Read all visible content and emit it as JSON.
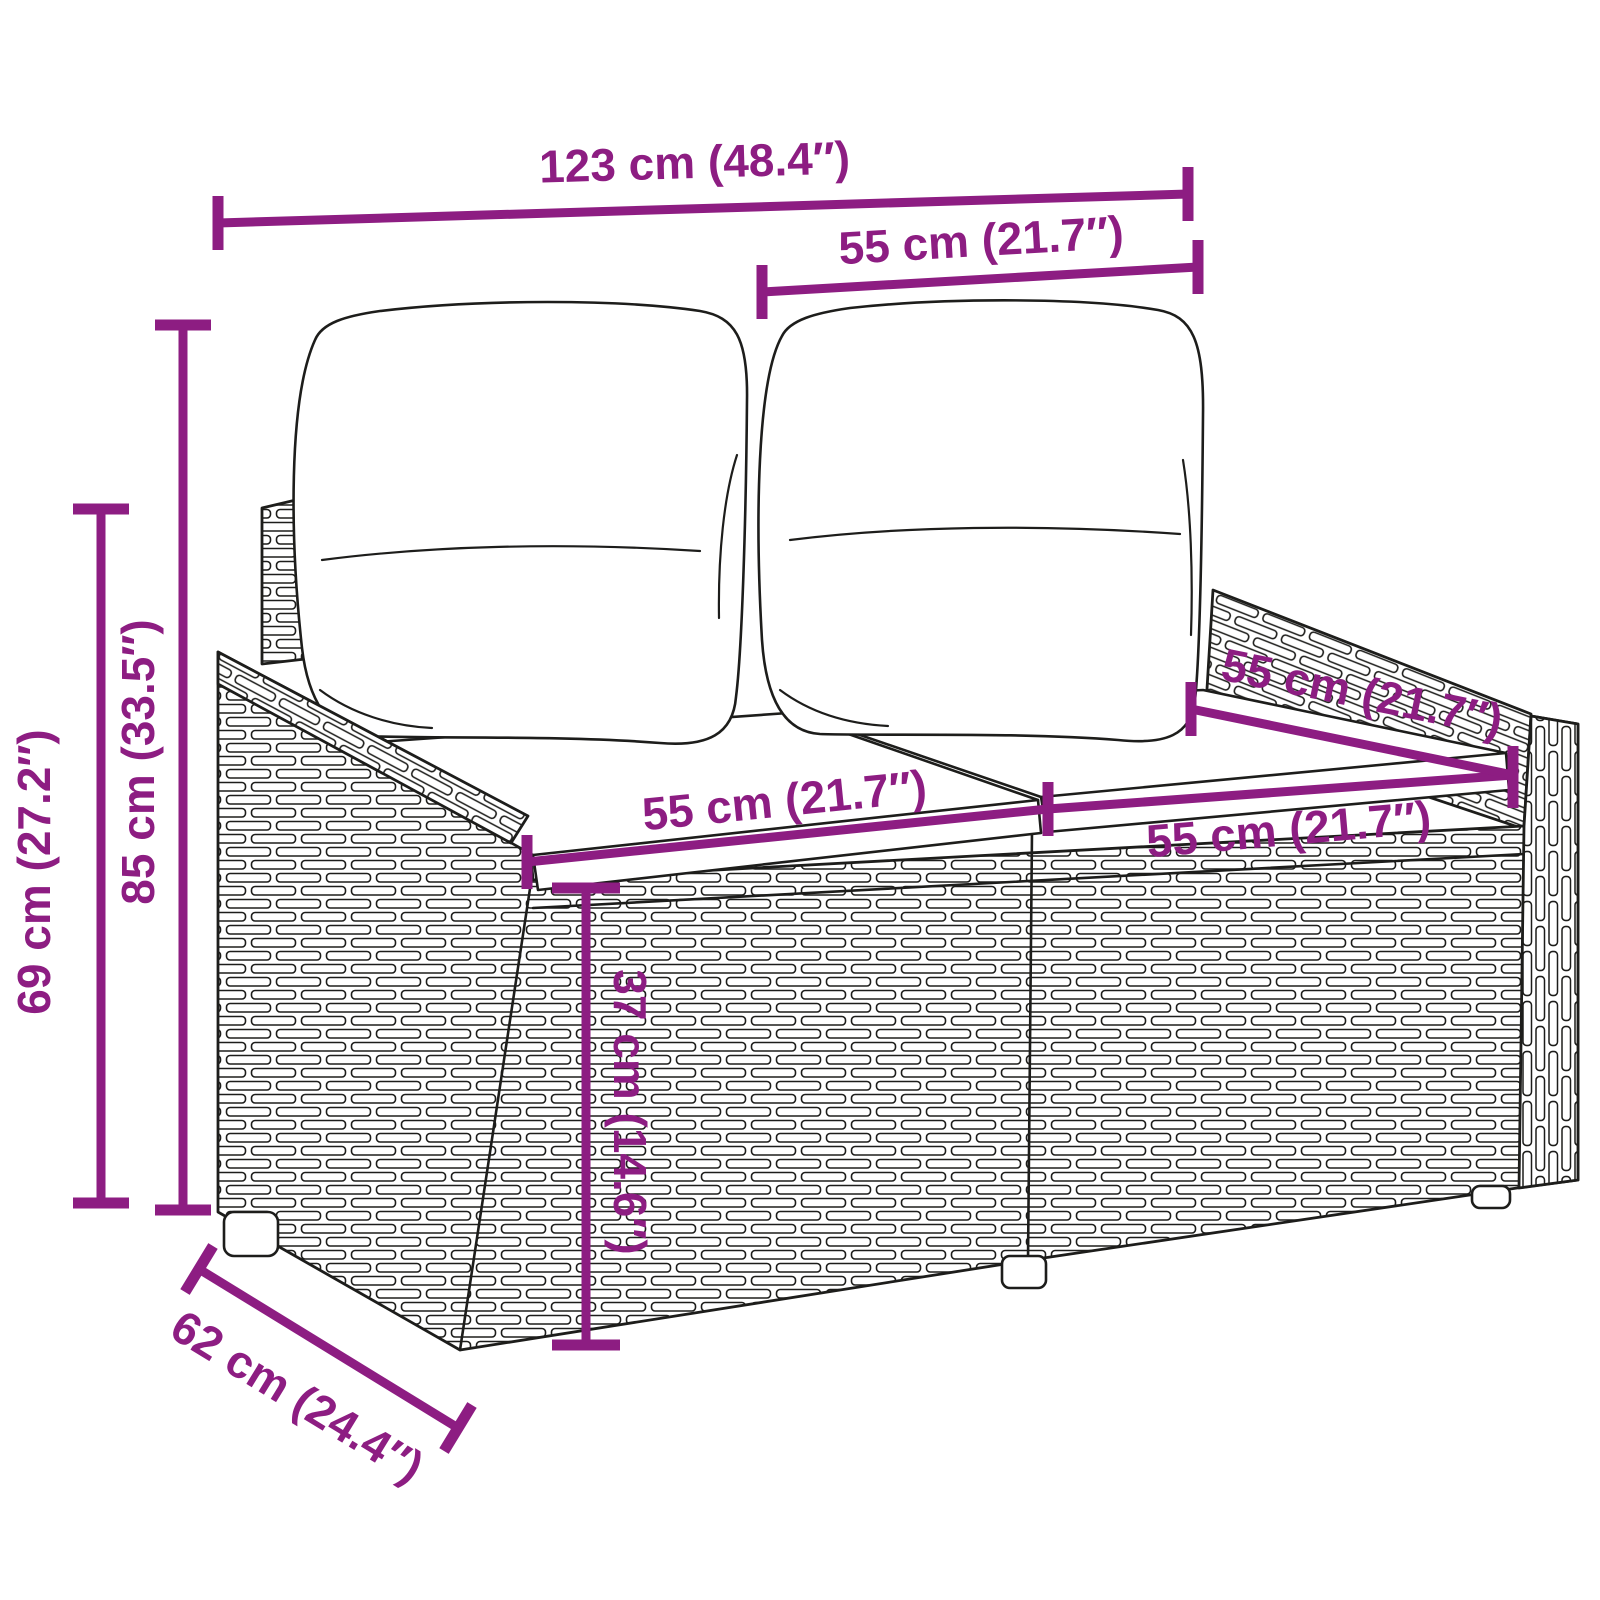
{
  "figure": {
    "background_color": "#ffffff",
    "line_color": "#1d1d1b",
    "accent_color": "#8D1D82",
    "subject": "poly-rattan 2-seater garden bench with back and seat cushions",
    "annotations": {
      "overall_width": "123 cm (48.4″)",
      "back_cushion_width": "55 cm (21.7″)",
      "total_height": "85 cm (33.5″)",
      "frame_height": "69 cm (27.2″)",
      "seat_depth": "55 cm (21.7″)",
      "seat_width_left": "55 cm (21.7″)",
      "seat_width_right": "55 cm (21.7″)",
      "seat_height": "37 cm (14.6″)",
      "overall_depth": "62 cm (24.4″)"
    }
  }
}
